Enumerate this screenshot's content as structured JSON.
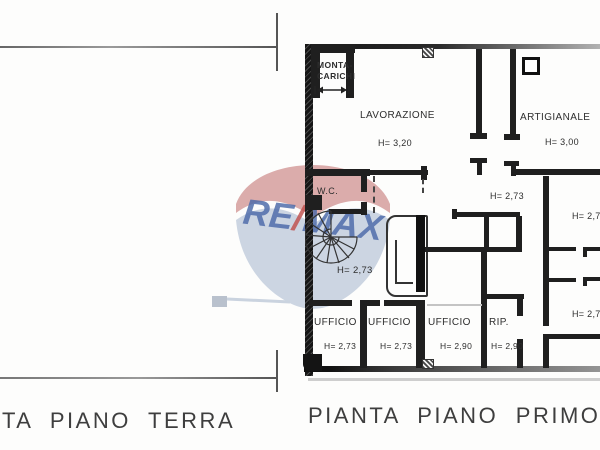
{
  "captions": {
    "terra": "TA PIANO TERRA",
    "primo": "PIANTA PIANO PRIMO"
  },
  "watermark": {
    "re": "RE",
    "slash": "/",
    "max": "MAX",
    "canopy_red": "#cf8d8d",
    "canopy_blue": "#bac7d9",
    "text_blue": "#4b69a9",
    "slash_red": "#c0504d"
  },
  "rooms": {
    "montacarichi_line1": "MONTA-",
    "montacarichi_line2": "CARICHI",
    "lavorazione": {
      "name": "LAVORAZIONE",
      "h": "H= 3,20"
    },
    "artigianale": {
      "name": "ARTIGIANALE",
      "h": "H= 3,00"
    },
    "wc": "W.C.",
    "h_center": "H= 2,73",
    "h_upper_right": "H= 2,73",
    "h_right_top": "H= 2,73",
    "h_right_bottom": "H= 2,73",
    "offices": [
      {
        "name": "UFFICIO",
        "h": "H= 2,73"
      },
      {
        "name": "UFFICIO",
        "h": "H= 2,73"
      },
      {
        "name": "UFFICIO",
        "h": "H= 2,90"
      },
      {
        "name": "RIP.",
        "h": "H= 2,90"
      }
    ]
  }
}
